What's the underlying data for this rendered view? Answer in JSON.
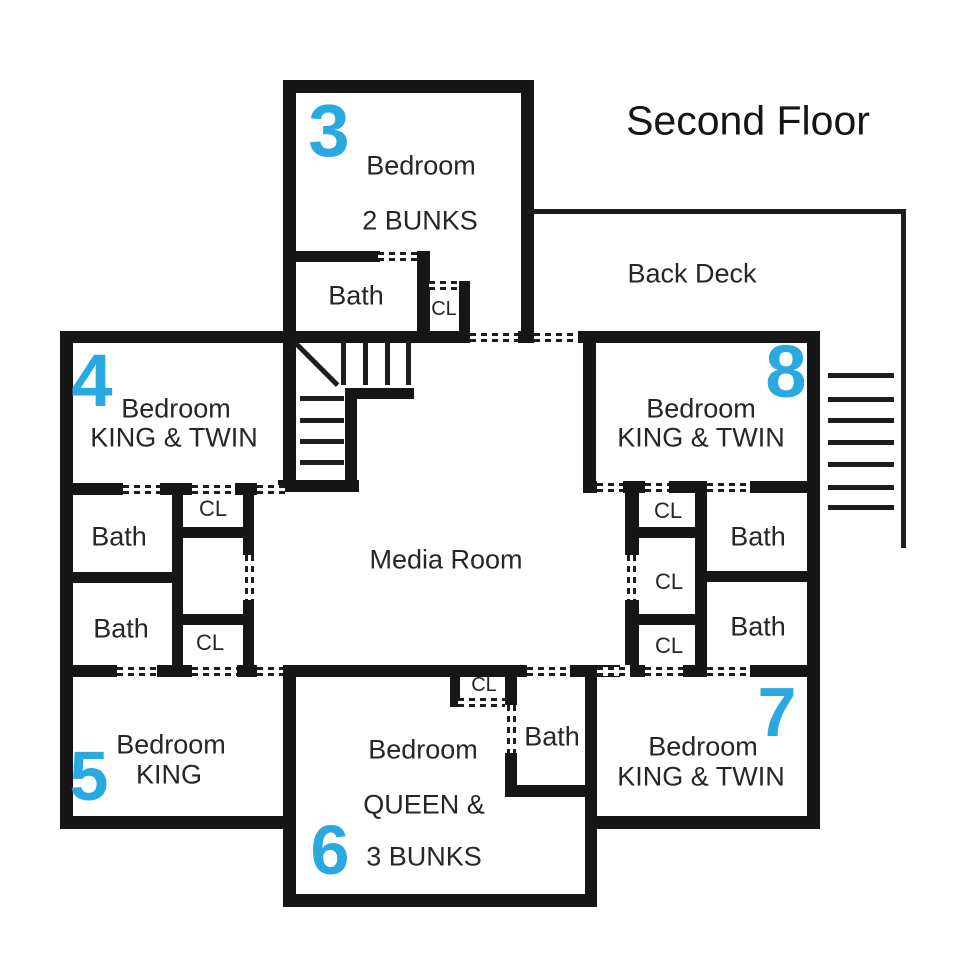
{
  "title": "Second Floor",
  "areas": {
    "back_deck": "Back Deck",
    "media_room": "Media Room"
  },
  "labels": {
    "bath": "Bath",
    "closet": "CL"
  },
  "bedrooms": {
    "b3": {
      "number": "3",
      "name": "Bedroom",
      "beds": "2 BUNKS"
    },
    "b4": {
      "number": "4",
      "name": "Bedroom",
      "beds": "KING & TWIN"
    },
    "b5": {
      "number": "5",
      "name": "Bedroom",
      "beds": "KING"
    },
    "b6": {
      "number": "6",
      "name": "Bedroom",
      "beds_line1": "QUEEN &",
      "beds_line2": "3 BUNKS"
    },
    "b7": {
      "number": "7",
      "name": "Bedroom",
      "beds": "KING & TWIN"
    },
    "b8": {
      "number": "8",
      "name": "Bedroom",
      "beds": "KING & TWIN"
    }
  },
  "colors": {
    "room_number": "#29a9e0",
    "wall": "#161616",
    "text": "#262626"
  }
}
